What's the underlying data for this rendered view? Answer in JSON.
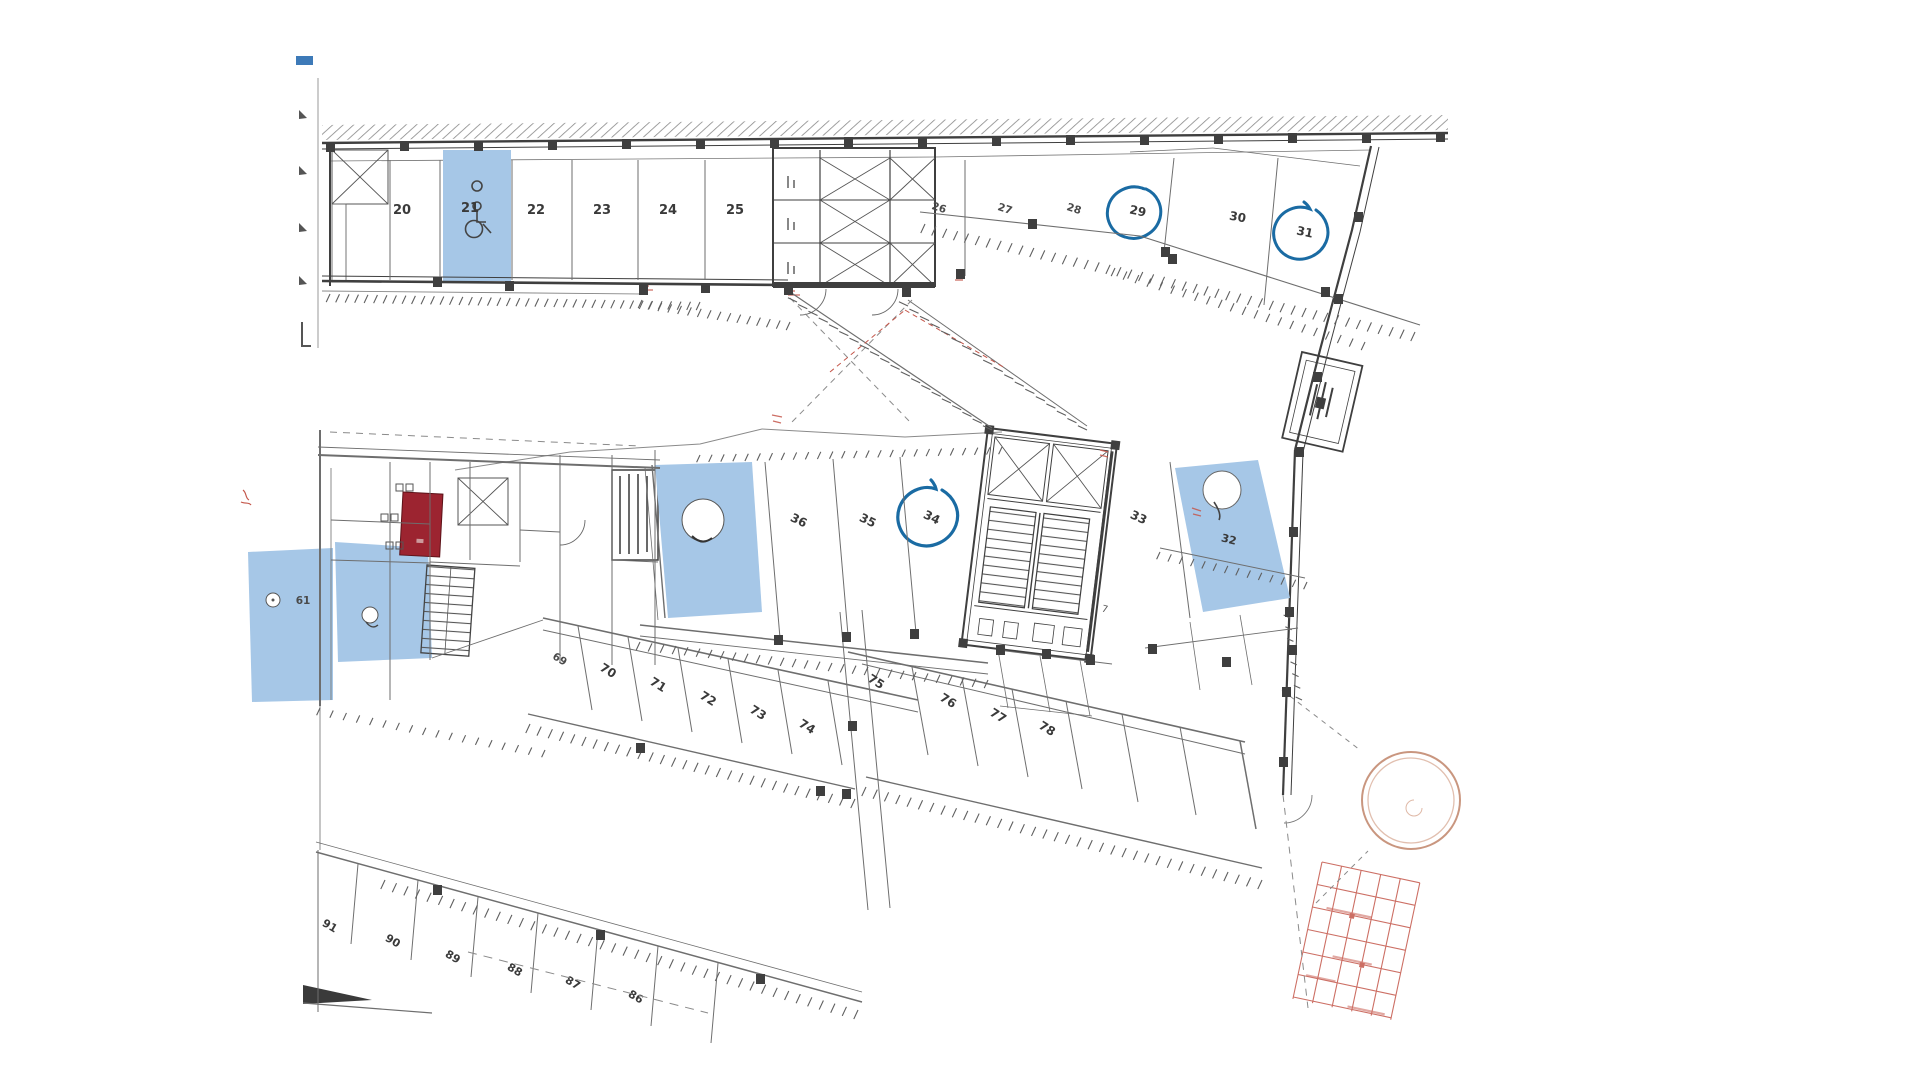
{
  "colors": {
    "paper": "#ffffff",
    "ink": "#3f3f3f",
    "highlight_blue": "#a6c7e7",
    "pen_blue": "#1a6ba3",
    "red_fill": "#9c2430",
    "red_line": "#c4564a",
    "sketch_red": "#c08468"
  },
  "plan": {
    "top_row_spaces": [
      "20",
      "21",
      "22",
      "23",
      "24",
      "25"
    ],
    "upper_right_spaces": [
      "26",
      "27",
      "28",
      "29",
      "30",
      "31"
    ],
    "middle_spaces": [
      "36",
      "35",
      "34",
      "33",
      "32"
    ],
    "left_space": "61",
    "small_room": "7",
    "lower_left_spaces": [
      "69",
      "70",
      "71",
      "72",
      "73",
      "74"
    ],
    "lower_right_spaces": [
      "75",
      "76",
      "77",
      "78"
    ],
    "bottom_row_spaces": [
      "91",
      "90",
      "89",
      "88",
      "87",
      "86"
    ],
    "annotations": {
      "pen_circled_spaces": [
        "29",
        "31",
        "34"
      ],
      "accessible_space": "21"
    }
  }
}
